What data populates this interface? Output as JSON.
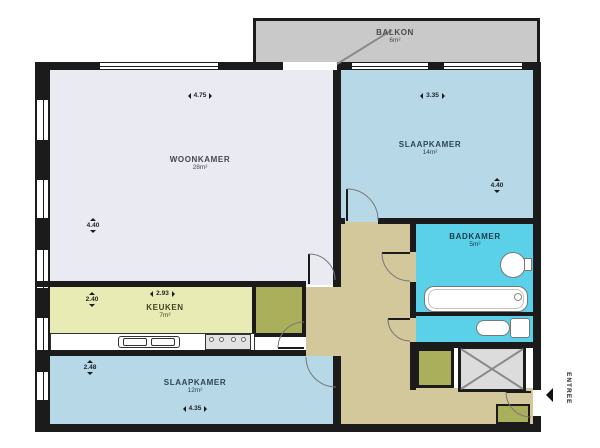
{
  "rooms": {
    "balkon": {
      "name": "BALKON",
      "area": "6m²"
    },
    "woonkamer": {
      "name": "WOONKAMER",
      "area": "28m²"
    },
    "slaapkamer1": {
      "name": "SLAAPKAMER",
      "area": "14m²"
    },
    "badkamer": {
      "name": "BADKAMER",
      "area": "5m²"
    },
    "keuken": {
      "name": "KEUKEN",
      "area": "7m²"
    },
    "slaapkamer2": {
      "name": "SLAAPKAMER",
      "area": "12m²"
    },
    "entree": {
      "name": "ENTREE"
    }
  },
  "dims": {
    "woonkamer_top": "4.75",
    "woonkamer_left": "4.40",
    "slaapkamer1_top": "3.35",
    "slaapkamer1_right": "4.40",
    "keuken_top": "2.93",
    "keuken_left": "2.40",
    "slaapkamer2_left": "2.48",
    "slaapkamer2_bottom": "4.35"
  },
  "colors": {
    "wall": "#1b1b1b",
    "living_room": "#eaeaf2",
    "bedroom": "#b7d8e6",
    "bathroom": "#5ad0e9",
    "kitchen": "#e8ecb4",
    "closet": "#a9af5b",
    "hall": "#d3c79c",
    "balcony": "#c9c9c9",
    "shaft": "#dcdcdc"
  }
}
